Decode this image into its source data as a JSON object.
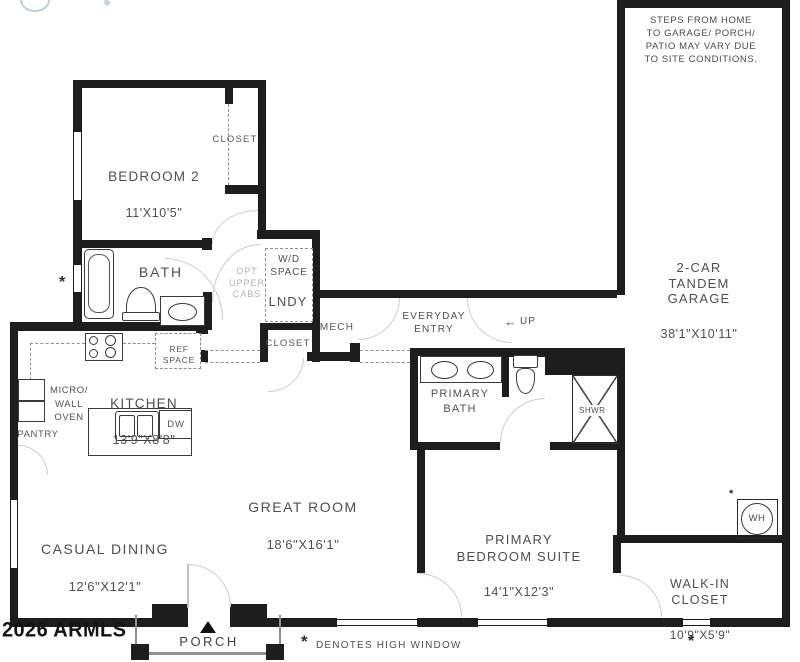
{
  "watermark": "2026 ARMLS",
  "legend": {
    "symbol": "*",
    "text": "DENOTES HIGH WINDOW"
  },
  "disclaimer": "STEPS FROM HOME\nTO GARAGE/ PORCH/\nPATIO MAY VARY DUE\nTO SITE CONDITIONS.",
  "symbols": {
    "high_window": "*",
    "porch_marker": "▲",
    "up_arrow": "←"
  },
  "rooms": {
    "bedroom2": {
      "name": "BEDROOM 2",
      "dims": "11'X10'5\""
    },
    "bedroom2_closet": {
      "name": "CLOSET"
    },
    "bath": {
      "name": "BATH"
    },
    "wd_space": {
      "name": "W/D\nSPACE"
    },
    "laundry": {
      "name": "LNDY"
    },
    "opt_upper_cabs": {
      "name": "OPT\nUPPER\nCABS"
    },
    "hall_closet": {
      "name": "CLOSET"
    },
    "mech": {
      "name": "MECH"
    },
    "everyday_entry": {
      "name": "EVERYDAY\nENTRY"
    },
    "stairs": {
      "name": "UP"
    },
    "kitchen": {
      "name": "KITCHEN",
      "dims": "13'9\"X8'8\""
    },
    "ref_space": {
      "name": "REF\nSPACE"
    },
    "micro_wall_oven": {
      "name": "MICRO/\nWALL\nOVEN"
    },
    "pantry": {
      "name": "PANTRY"
    },
    "dishwasher": {
      "name": "DW"
    },
    "casual_dining": {
      "name": "CASUAL DINING",
      "dims": "12'6\"X12'1\""
    },
    "great_room": {
      "name": "GREAT ROOM",
      "dims": "18'6\"X16'1\""
    },
    "primary_bath": {
      "name": "PRIMARY\nBATH"
    },
    "shower": {
      "name": "SHWR"
    },
    "primary_bedroom": {
      "name": "PRIMARY\nBEDROOM SUITE",
      "dims": "14'1\"X12'3\""
    },
    "walk_in_closet": {
      "name": "WALK-IN\nCLOSET",
      "dims": "10'9\"X5'9\""
    },
    "garage": {
      "name": "2-CAR\nTANDEM\nGARAGE",
      "dims": "38'1\"X10'11\""
    },
    "water_heater": {
      "name": "WH"
    },
    "porch": {
      "name": "PORCH"
    }
  },
  "colors": {
    "wall": "#1d1d1d",
    "text": "#4f4f4f",
    "muted": "#b3b3b3",
    "logo": "#b9cede"
  }
}
